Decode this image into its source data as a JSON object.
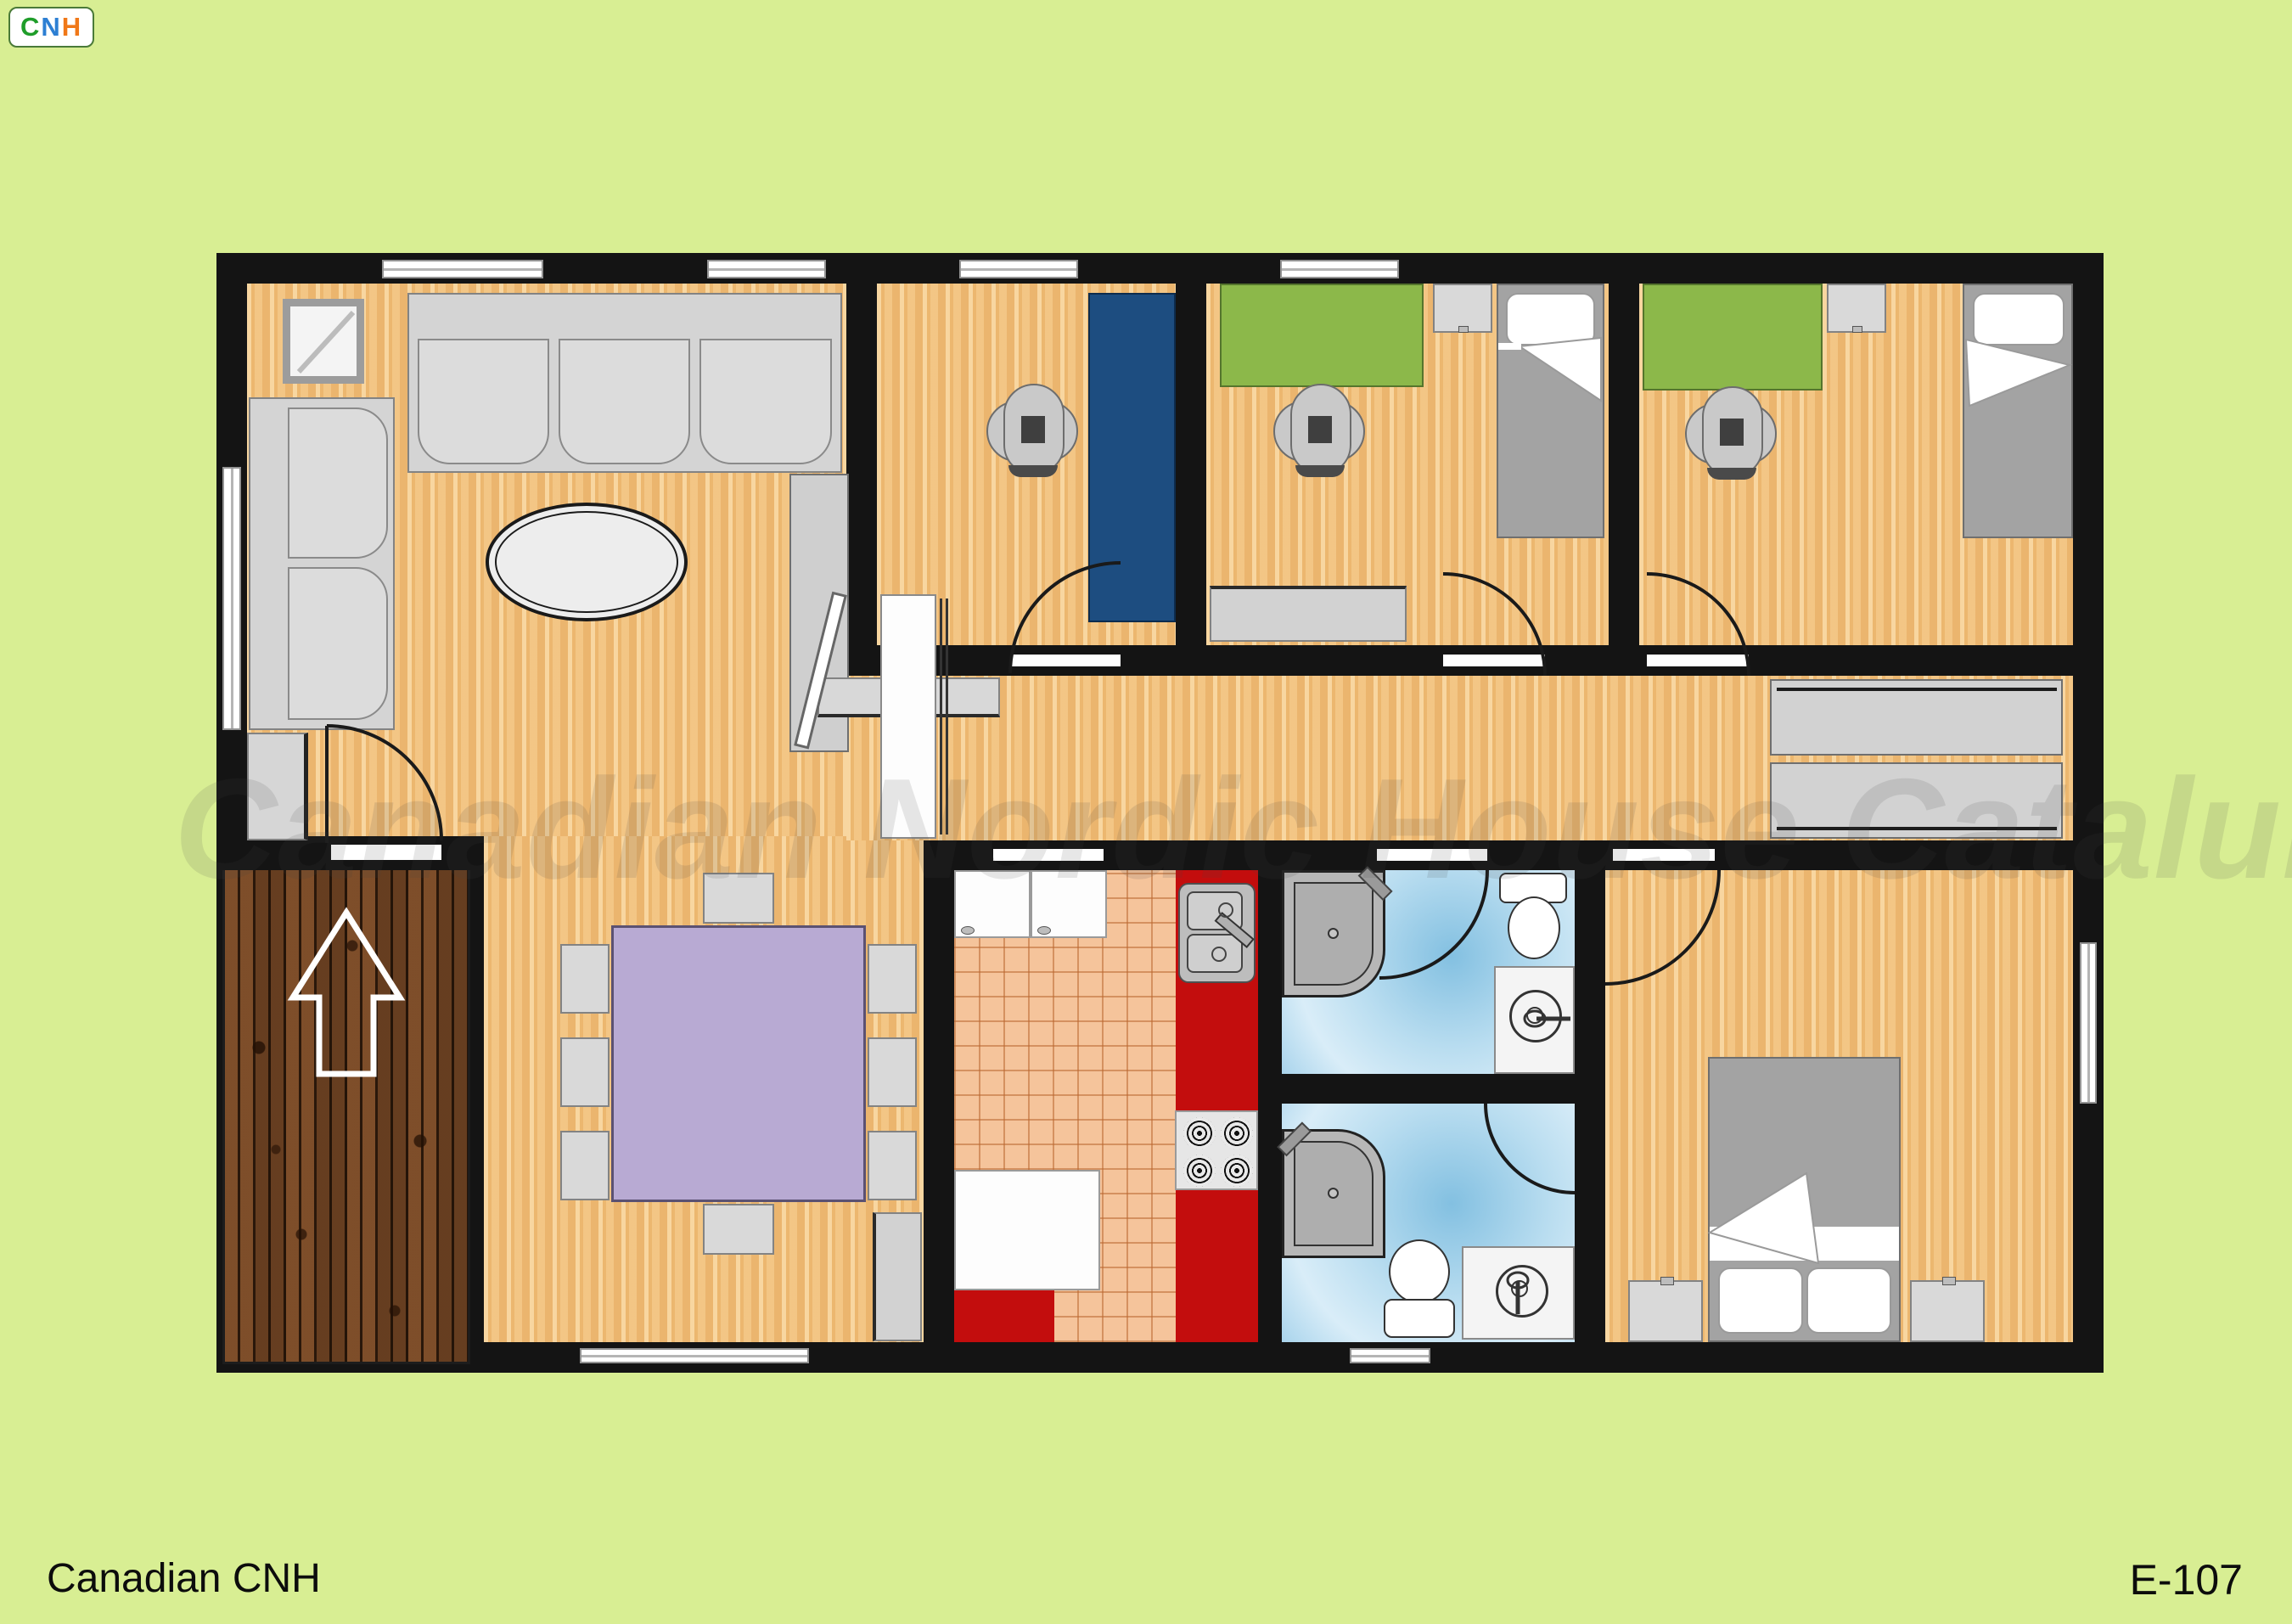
{
  "branding": {
    "logo_letters": [
      {
        "char": "C",
        "color": "#1f9d2a"
      },
      {
        "char": "N",
        "color": "#2d7fd3"
      },
      {
        "char": "H",
        "color": "#f07818"
      }
    ]
  },
  "watermark": {
    "text": "Canadian Nordic House Catalunya"
  },
  "footer": {
    "left": "Canadian CNH",
    "right": "E-107"
  },
  "palette": {
    "background": "#d8ee93",
    "wall": "#141414",
    "wood_floor": "#f1c07c",
    "deck_wood": "#7a4b28",
    "kitchen_tile": "#f5c49b",
    "kitchen_counter_red": "#c30d0d",
    "bathroom_floor_blue": "#a9d4ec",
    "desk_green": "#8cb84a",
    "desk_blue": "#1d4d80",
    "dining_table_lavender": "#b8aad3",
    "furniture_gray": "#d9d9d9",
    "bed_gray": "#a3a3a3"
  }
}
